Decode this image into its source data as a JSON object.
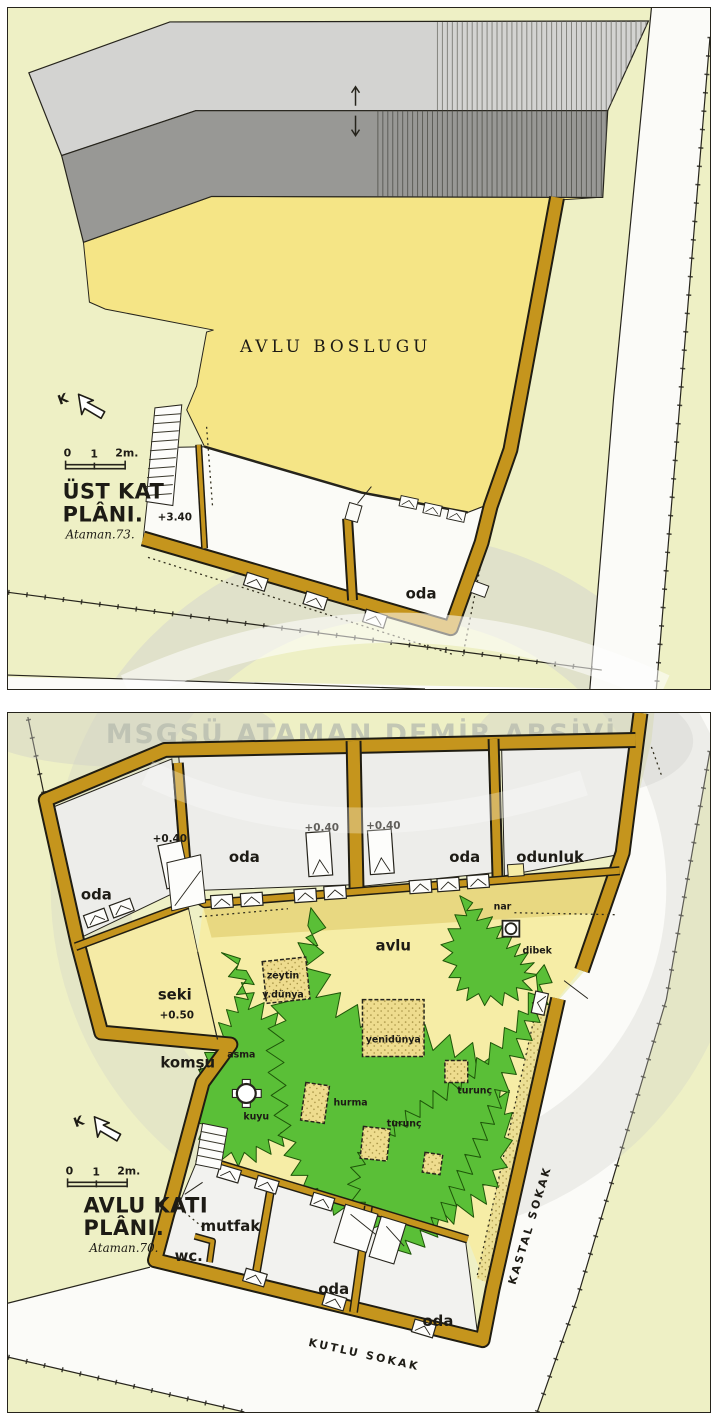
{
  "watermark": {
    "archive_text": "MSGSÜ ATAMAN DEMİR ARŞİVİ"
  },
  "upper_plan": {
    "north_label": "K",
    "scale": {
      "zero": "0",
      "one": "1",
      "two": "2m."
    },
    "title_line1": "ÜST KAT",
    "title_line2": "PLÂNI.",
    "signature": "Ataman.73.",
    "courtyard_label": "AVLU BOSLUGU",
    "level_label": "+3.40",
    "room_oda": "oda"
  },
  "courtyard_plan": {
    "north_label": "K",
    "scale": {
      "zero": "0",
      "one": "1",
      "two": "2m."
    },
    "title_line1": "AVLU KATI",
    "title_line2": "PLÂNI.",
    "signature": "Ataman.70.",
    "rooms": {
      "oda_nw": "oda",
      "oda_n1": "oda",
      "oda_n2": "oda",
      "odunluk": "odunluk",
      "seki": "seki",
      "seki_level": "+0.50",
      "komsu": "komşu",
      "avlu": "avlu",
      "mutfak": "mutfak",
      "wc": "wc.",
      "oda_s1": "oda",
      "oda_s2": "oda"
    },
    "levels": {
      "door1": "+0.40",
      "door2": "+0.40",
      "door3": "+0.40"
    },
    "garden": {
      "zeytin": "zeytin",
      "ydunya": "y.dünya",
      "yenidunya": "yenidünya",
      "hurma": "hurma",
      "turunc_s": "turunç",
      "turunc_e": "turunç",
      "nar": "nar",
      "dibek": "dibek",
      "kuyu": "kuyu",
      "asma": "asma"
    },
    "streets": {
      "kastal": "KASTAL SOKAK",
      "kutlu": "KUTLU SOKAK"
    }
  },
  "colors": {
    "paper_green": "#eef0c5",
    "courtyard_yellow": "#f5e586",
    "wall_ochre": "#c5951d",
    "garden_green": "#5abf37",
    "roof_light": "#d3d3d1",
    "roof_dark": "#989895",
    "street_white": "#fbfbf8"
  }
}
